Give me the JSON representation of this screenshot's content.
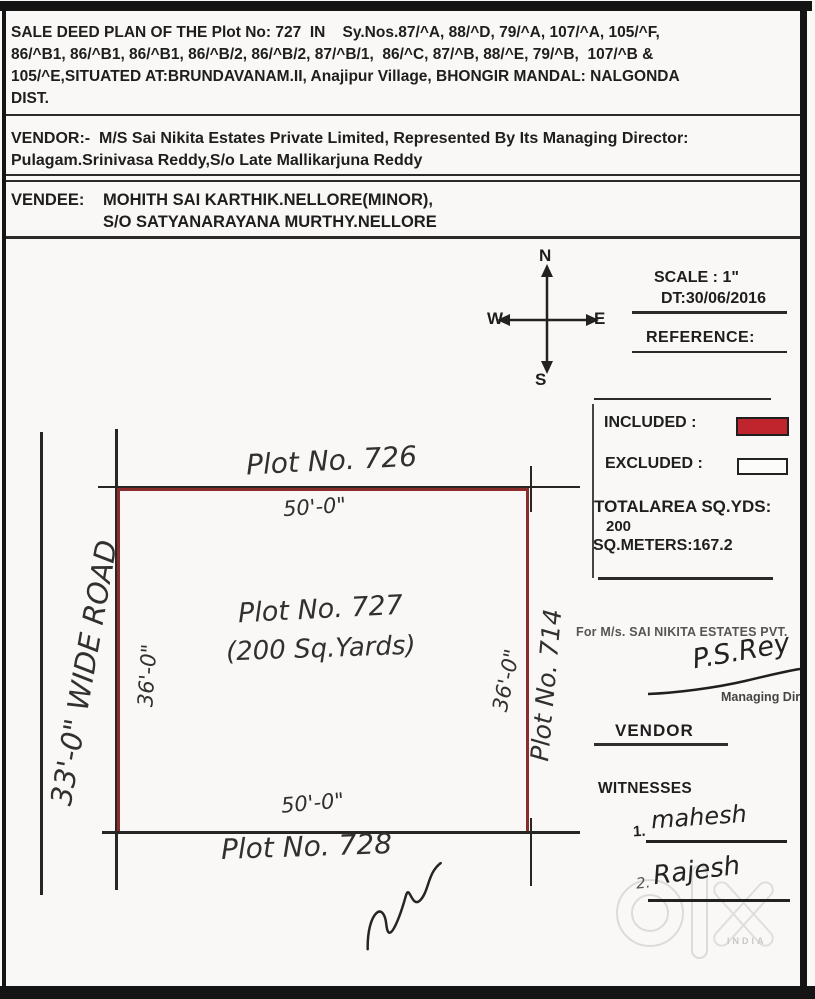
{
  "deed": {
    "title_lines": [
      "SALE DEED PLAN OF THE Plot No: 727  IN    Sy.Nos.87/^A, 88/^D, 79/^A, 107/^A, 105/^F,",
      "86/^B1, 86/^B1, 86/^B1, 86/^B/2, 86/^B/2, 87/^B/1,  86/^C, 87/^B, 88/^E, 79/^B,  107/^B &",
      "105/^E,SITUATED AT:BRUNDAVANAM.II, Anajipur Village, BHONGIR MANDAL: NALGONDA",
      "DIST."
    ]
  },
  "vendor": {
    "line1": "VENDOR:-  M/S Sai Nikita Estates Private Limited, Represented By Its Managing Director:",
    "line2": "Pulagam.Srinivasa Reddy,S/o Late Mallikarjuna Reddy"
  },
  "vendee": {
    "label": "VENDEE:",
    "line1": "MOHITH SAI KARTHIK.NELLORE(MINOR),",
    "line2": "S/O SATYANARAYANA MURTHY.NELLORE"
  },
  "compass": {
    "north": "N",
    "south": "S",
    "east": "E",
    "west": "W"
  },
  "scale_block": {
    "scale": "SCALE : 1\"",
    "date": "DT:30/06/2016",
    "reference": "REFERENCE:"
  },
  "legend": {
    "included_label": "INCLUDED :",
    "excluded_label": "EXCLUDED :",
    "total_area_label": "TOTALAREA SQ.YDS:",
    "total_area_value": "200",
    "sq_meters": "SQ.METERS:167.2",
    "included_color": "#c0242c",
    "boundary_color": "#8b2d2d"
  },
  "plot": {
    "north_neighbor": "Plot No. 726",
    "north_dim": "50'-0\"",
    "name": "Plot No. 727",
    "area": "(200 Sq.Yards)",
    "west_dim": "36'-0\"",
    "east_dim": "36'-0\"",
    "east_neighbor": "Plot No. 714",
    "south_dim": "50'-0\"",
    "south_neighbor": "Plot No. 728",
    "road": "33'-0\" WIDE ROAD"
  },
  "signature_block": {
    "for_company": "For M/s. SAI NIKITA ESTATES PVT.",
    "md_signature": "P.S.Rey",
    "managing_director": "Managing Dire",
    "vendor_label": "VENDOR",
    "witnesses_label": "WITNESSES",
    "witness1_num": "1.",
    "witness1_sig": "mahesh",
    "witness2_num": "2.",
    "witness2_sig": "Rajesh"
  },
  "watermark": {
    "country": "INDIA"
  }
}
